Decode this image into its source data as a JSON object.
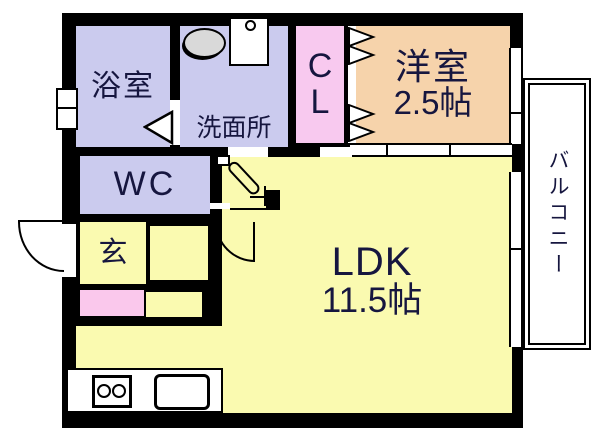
{
  "plan": {
    "type": "apartment-floor-plan",
    "rooms": {
      "bath": {
        "label": "浴室"
      },
      "washroom": {
        "label": "洗面所"
      },
      "closet": {
        "line1": "C",
        "line2": "L"
      },
      "western_room": {
        "label": "洋室",
        "size": "2.5帖"
      },
      "wc": {
        "label": "WC"
      },
      "entrance": {
        "label": "玄"
      },
      "ldk": {
        "label": "LDK",
        "size": "11.5帖"
      },
      "balcony": {
        "label": "バルコニー"
      }
    },
    "fixtures": {
      "wash_basin": "oval-basin-icon",
      "washing_machine_pan": "washer-pan-icon",
      "stove": "two-burner-stove-icon",
      "kitchen_sink": "kitchen-sink-icon"
    },
    "colors": {
      "wall": "#000000",
      "lavender_rooms": "#cbcbee",
      "closet_pink": "#f8c9ef",
      "shoebox_pink": "#fac8ec",
      "western_peach": "#f6d3ab",
      "ldk_yellow": "#fafab0",
      "basin_gray": "#d9d9d9",
      "text": "#16163f",
      "background": "#ffffff"
    }
  }
}
